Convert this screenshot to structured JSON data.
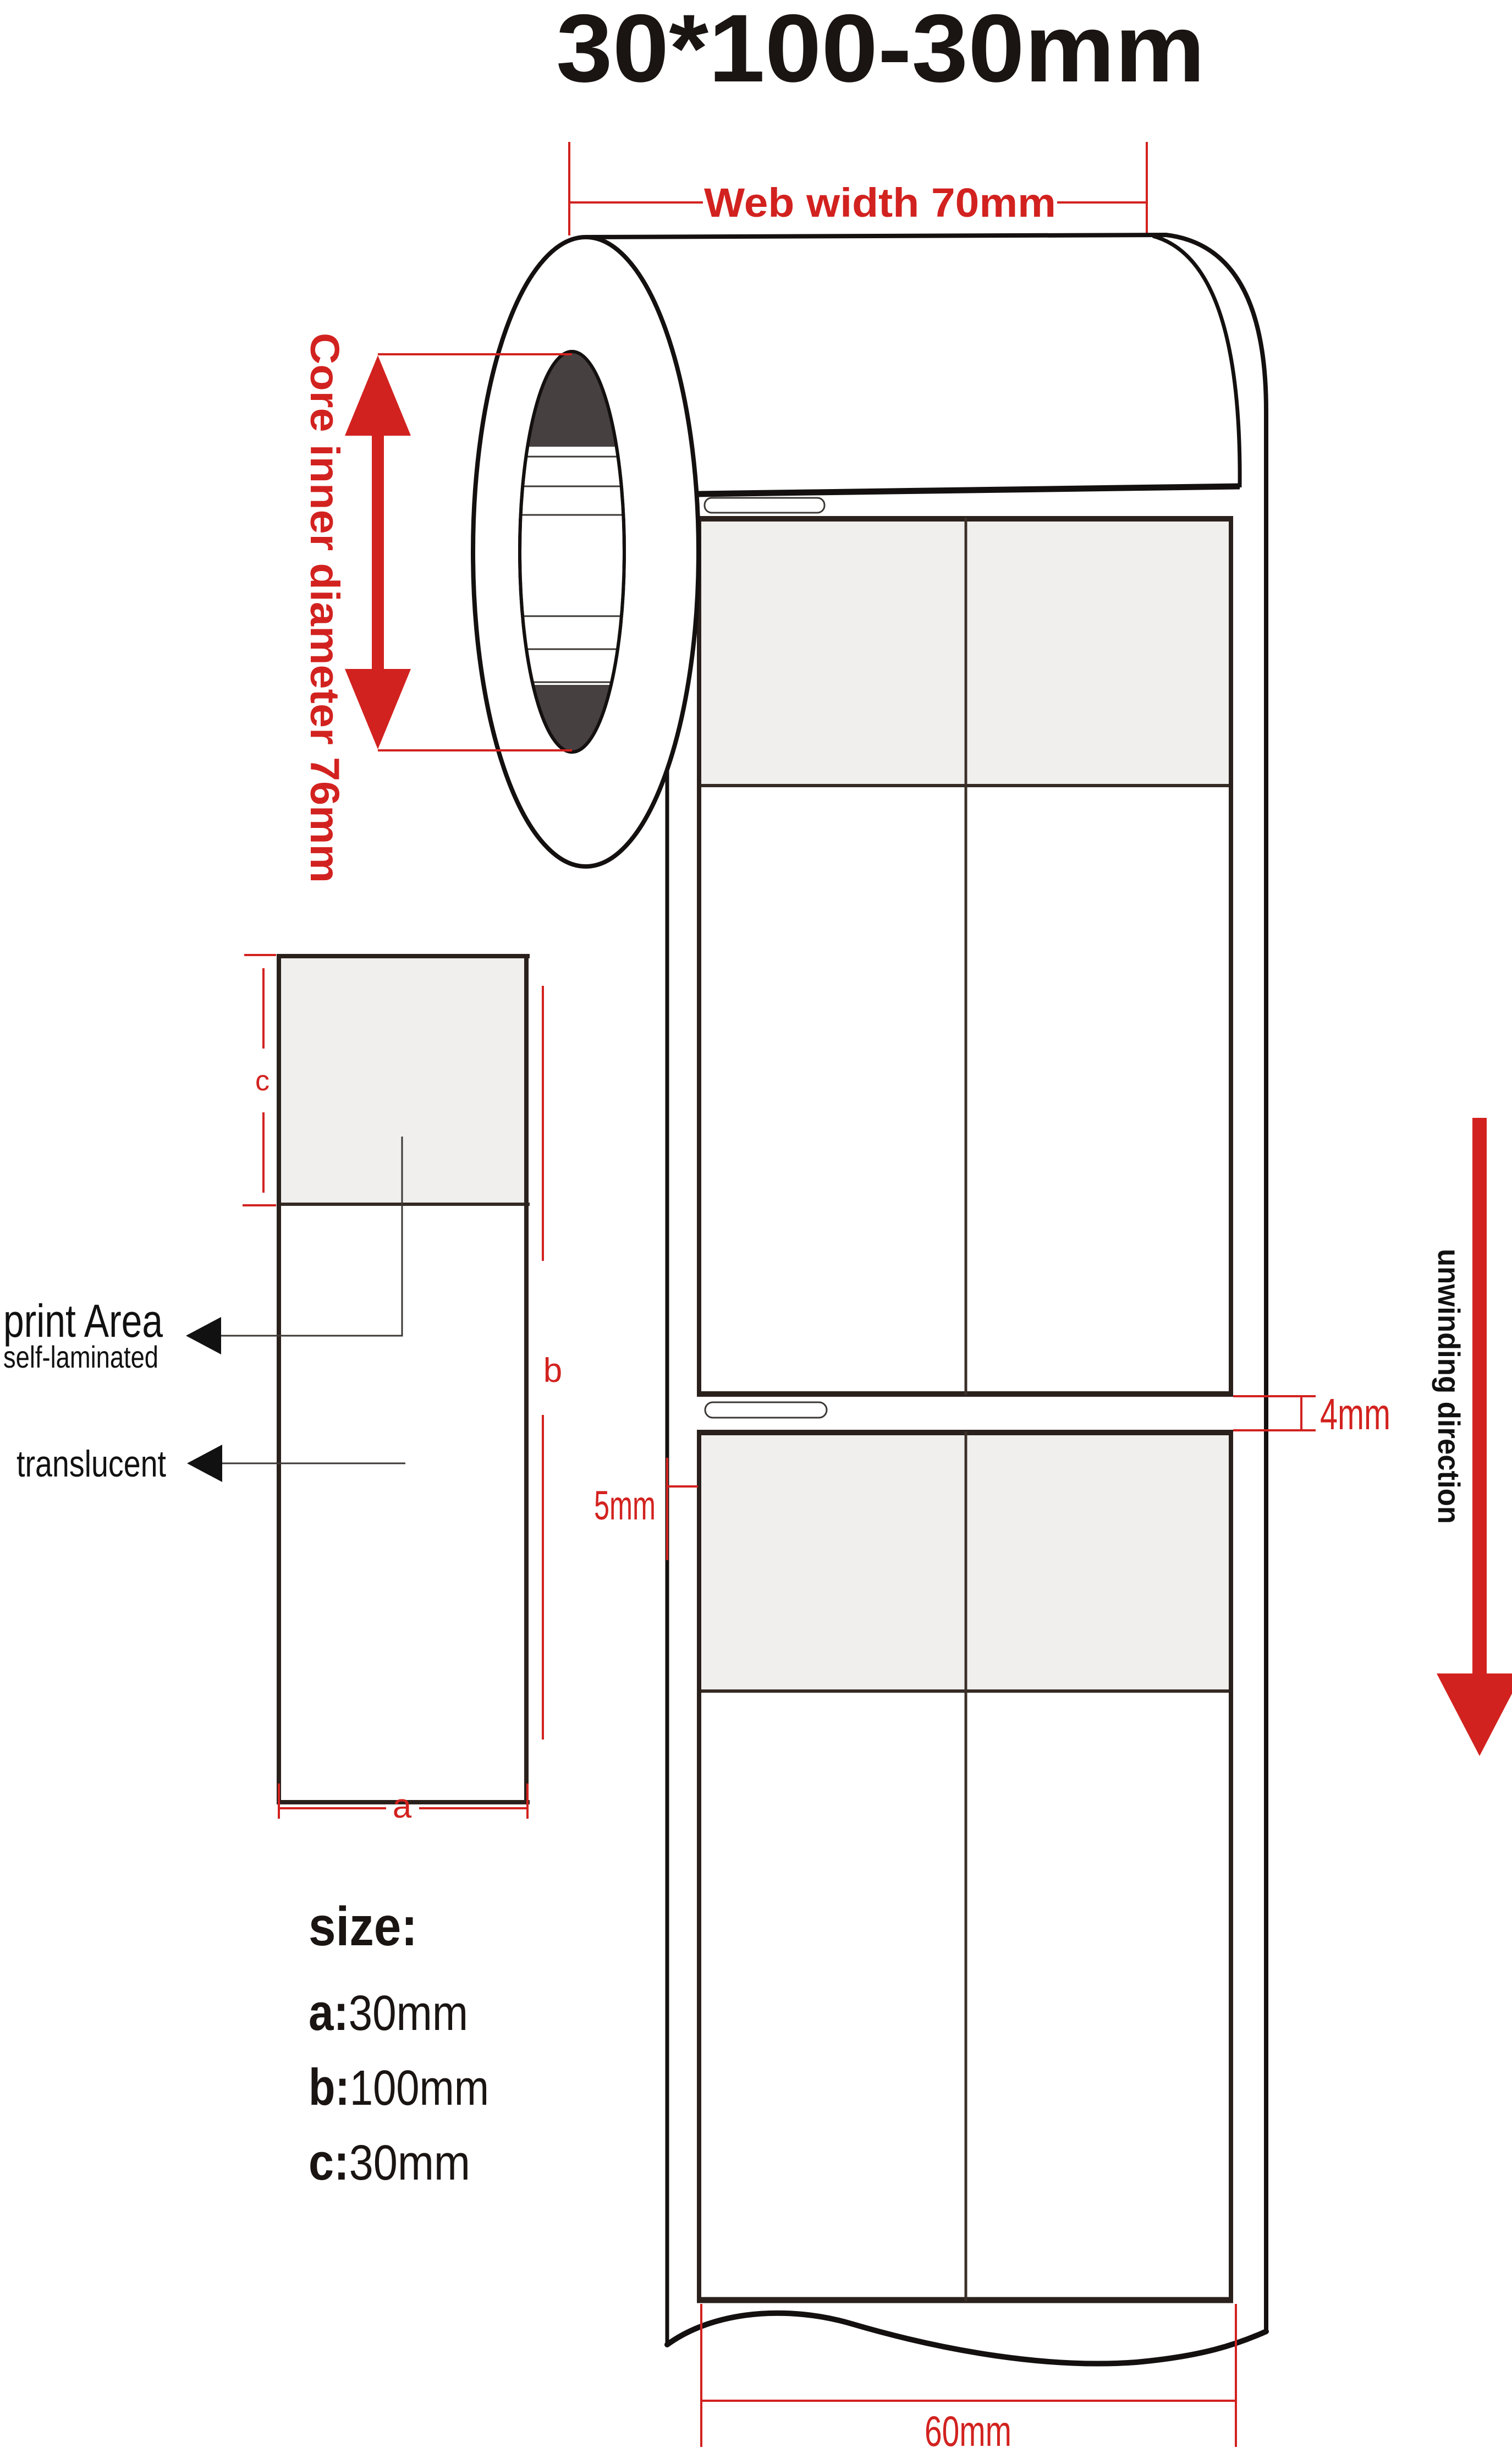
{
  "title": "30*100-30mm",
  "roll": {
    "web_width_label": "Web width 70mm",
    "core_label": "Core inner diameter 76mm",
    "unwinding_label": "unwinding direction"
  },
  "strip": {
    "gap_label": "4mm",
    "edge_margin_label": "5mm",
    "bottom_width_label": "60mm"
  },
  "detail": {
    "print_area_label": "print Area",
    "self_laminated_label": "self-laminated",
    "translucent_label": "translucent",
    "dim_a": "a",
    "dim_b": "b",
    "dim_c": "c"
  },
  "size_block": {
    "heading": "size:",
    "items": [
      {
        "prefix": "a:",
        "value": "30mm"
      },
      {
        "prefix": "b:",
        "value": "100mm"
      },
      {
        "prefix": "c:",
        "value": "30mm"
      }
    ]
  },
  "colors": {
    "dimension_red": "#d2221f",
    "outline_black": "#151010",
    "label_border": "#2b211c",
    "label_gray_fill": "#f0efed",
    "core_dark": "#474041",
    "text_black": "#111111"
  }
}
